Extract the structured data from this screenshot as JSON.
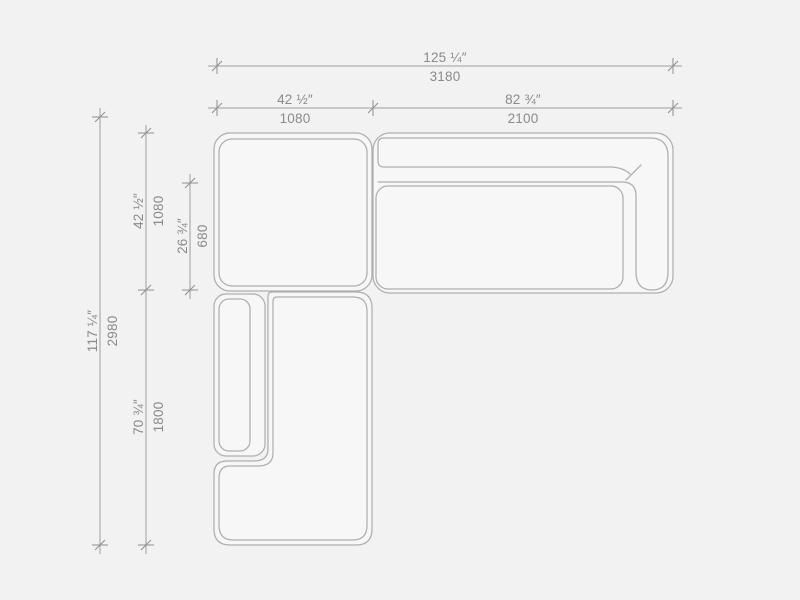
{
  "page": {
    "background_color": "#f2f2f2"
  },
  "drawing": {
    "name": "Sectional sofa plan view with dimensions",
    "view": "top",
    "colors": {
      "background": "#f2f2f2",
      "module_fill": "#f7f7f7",
      "module_outline": "#aeaeae",
      "dimension_line": "#9f9f9f",
      "label_text": "#8a8a8a"
    },
    "dimensions": {
      "total_width": {
        "inches": "125 ¼″",
        "mm": "3180"
      },
      "left_section_width": {
        "inches": "42 ½″",
        "mm": "1080"
      },
      "right_section_width": {
        "inches": "82 ¾″",
        "mm": "2100"
      },
      "total_depth": {
        "inches": "117 ¼″",
        "mm": "2980"
      },
      "upper_left_depth": {
        "inches": "42 ½″",
        "mm": "1080"
      },
      "seat_depth": {
        "inches": "26 ¾″",
        "mm": "680"
      },
      "chaise_depth": {
        "inches": "70 ¾″",
        "mm": "1800"
      }
    },
    "modules": [
      {
        "id": "corner-seat",
        "label": "corner seat module"
      },
      {
        "id": "sofa-right",
        "label": "sofa module with back and right armrest"
      },
      {
        "id": "chaise-left",
        "label": "chaise module with left armrest"
      }
    ]
  }
}
